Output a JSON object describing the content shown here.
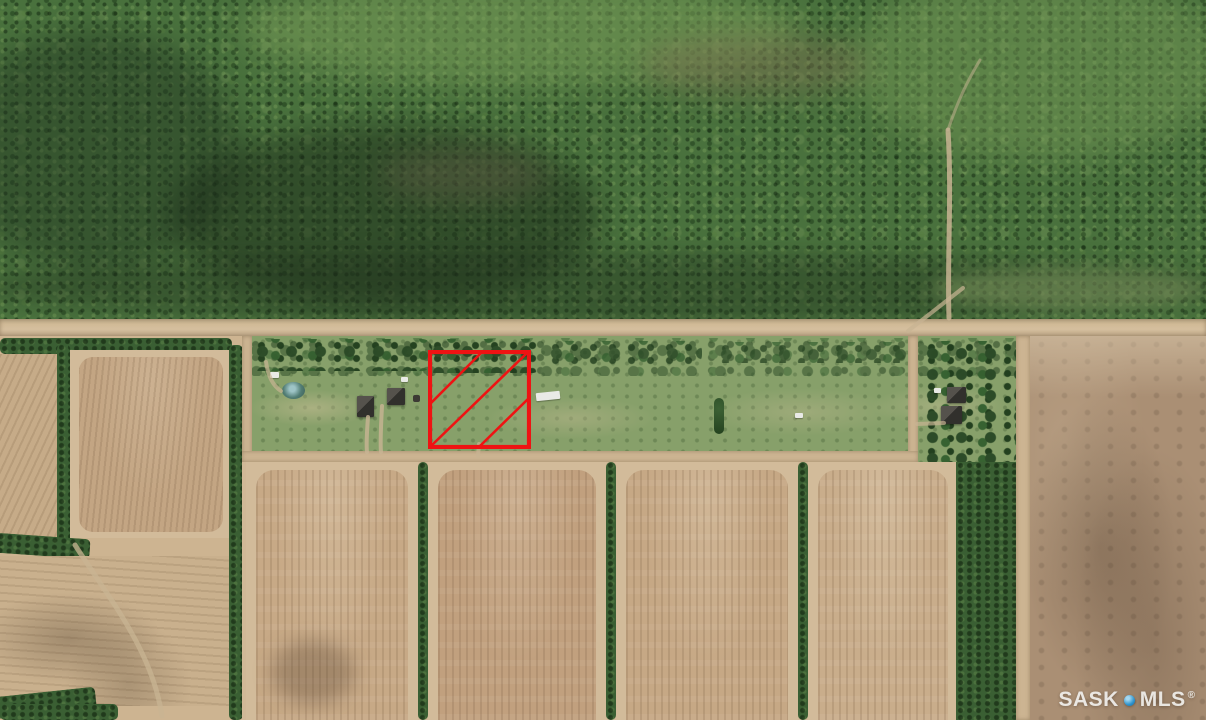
{
  "scene": {
    "type": "aerial-satellite-photo",
    "subject": "Aerial view of a rural acreage lot highlighted in red beside an east-west gravel road, with forest to the north and cultivated fields to the south"
  },
  "watermark": {
    "left_text": "SASK",
    "right_text": "MLS",
    "registered_mark": "®"
  },
  "parcel_overlay": {
    "shape": "square-with-diagonal-hatch",
    "hatch_line_count": 3,
    "x": 428,
    "y": 350,
    "width": 103,
    "height": 99
  },
  "colors": {
    "forest_green": "#49713d",
    "tree_dark": "#2c4d28",
    "grass_strip": "#87a06a",
    "hedgerow_green": "#3a5f33",
    "road_tan": "#ccb492",
    "field_light": "#d2bb9a",
    "field_tilled": "#c3a483",
    "field_dark_right": "#aa8f74",
    "pond_teal": "#527d74",
    "parcel_red": "#ee1313",
    "watermark_text": "#f0efec",
    "watermark_dot": "#2f94cd"
  }
}
